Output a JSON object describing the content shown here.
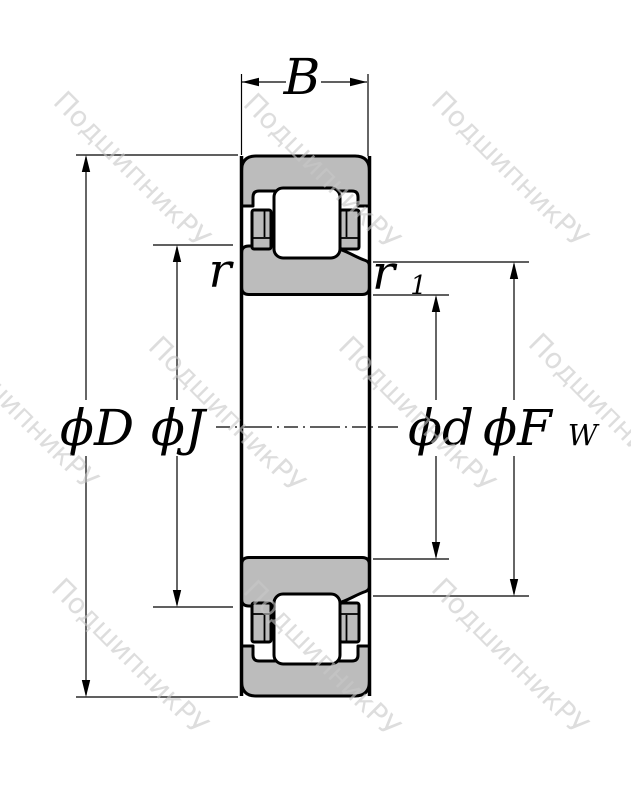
{
  "dimensions": {
    "width": "B",
    "outer_diameter": "ϕD",
    "inner_rib_diameter": "ϕJ",
    "bore_diameter": "ϕd",
    "raceway_diameter_main": "ϕF",
    "raceway_diameter_sub": "W",
    "outer_chamfer": "r",
    "inner_chamfer_main": "r",
    "inner_chamfer_sub": "1"
  },
  "colors": {
    "ring_fill": "#bcbcbc",
    "roller_fill": "#ffffff",
    "line": "#000000",
    "background": "#ffffff"
  },
  "watermark": {
    "text": "ПодшипникРУ",
    "color": "#c8c8c8"
  }
}
